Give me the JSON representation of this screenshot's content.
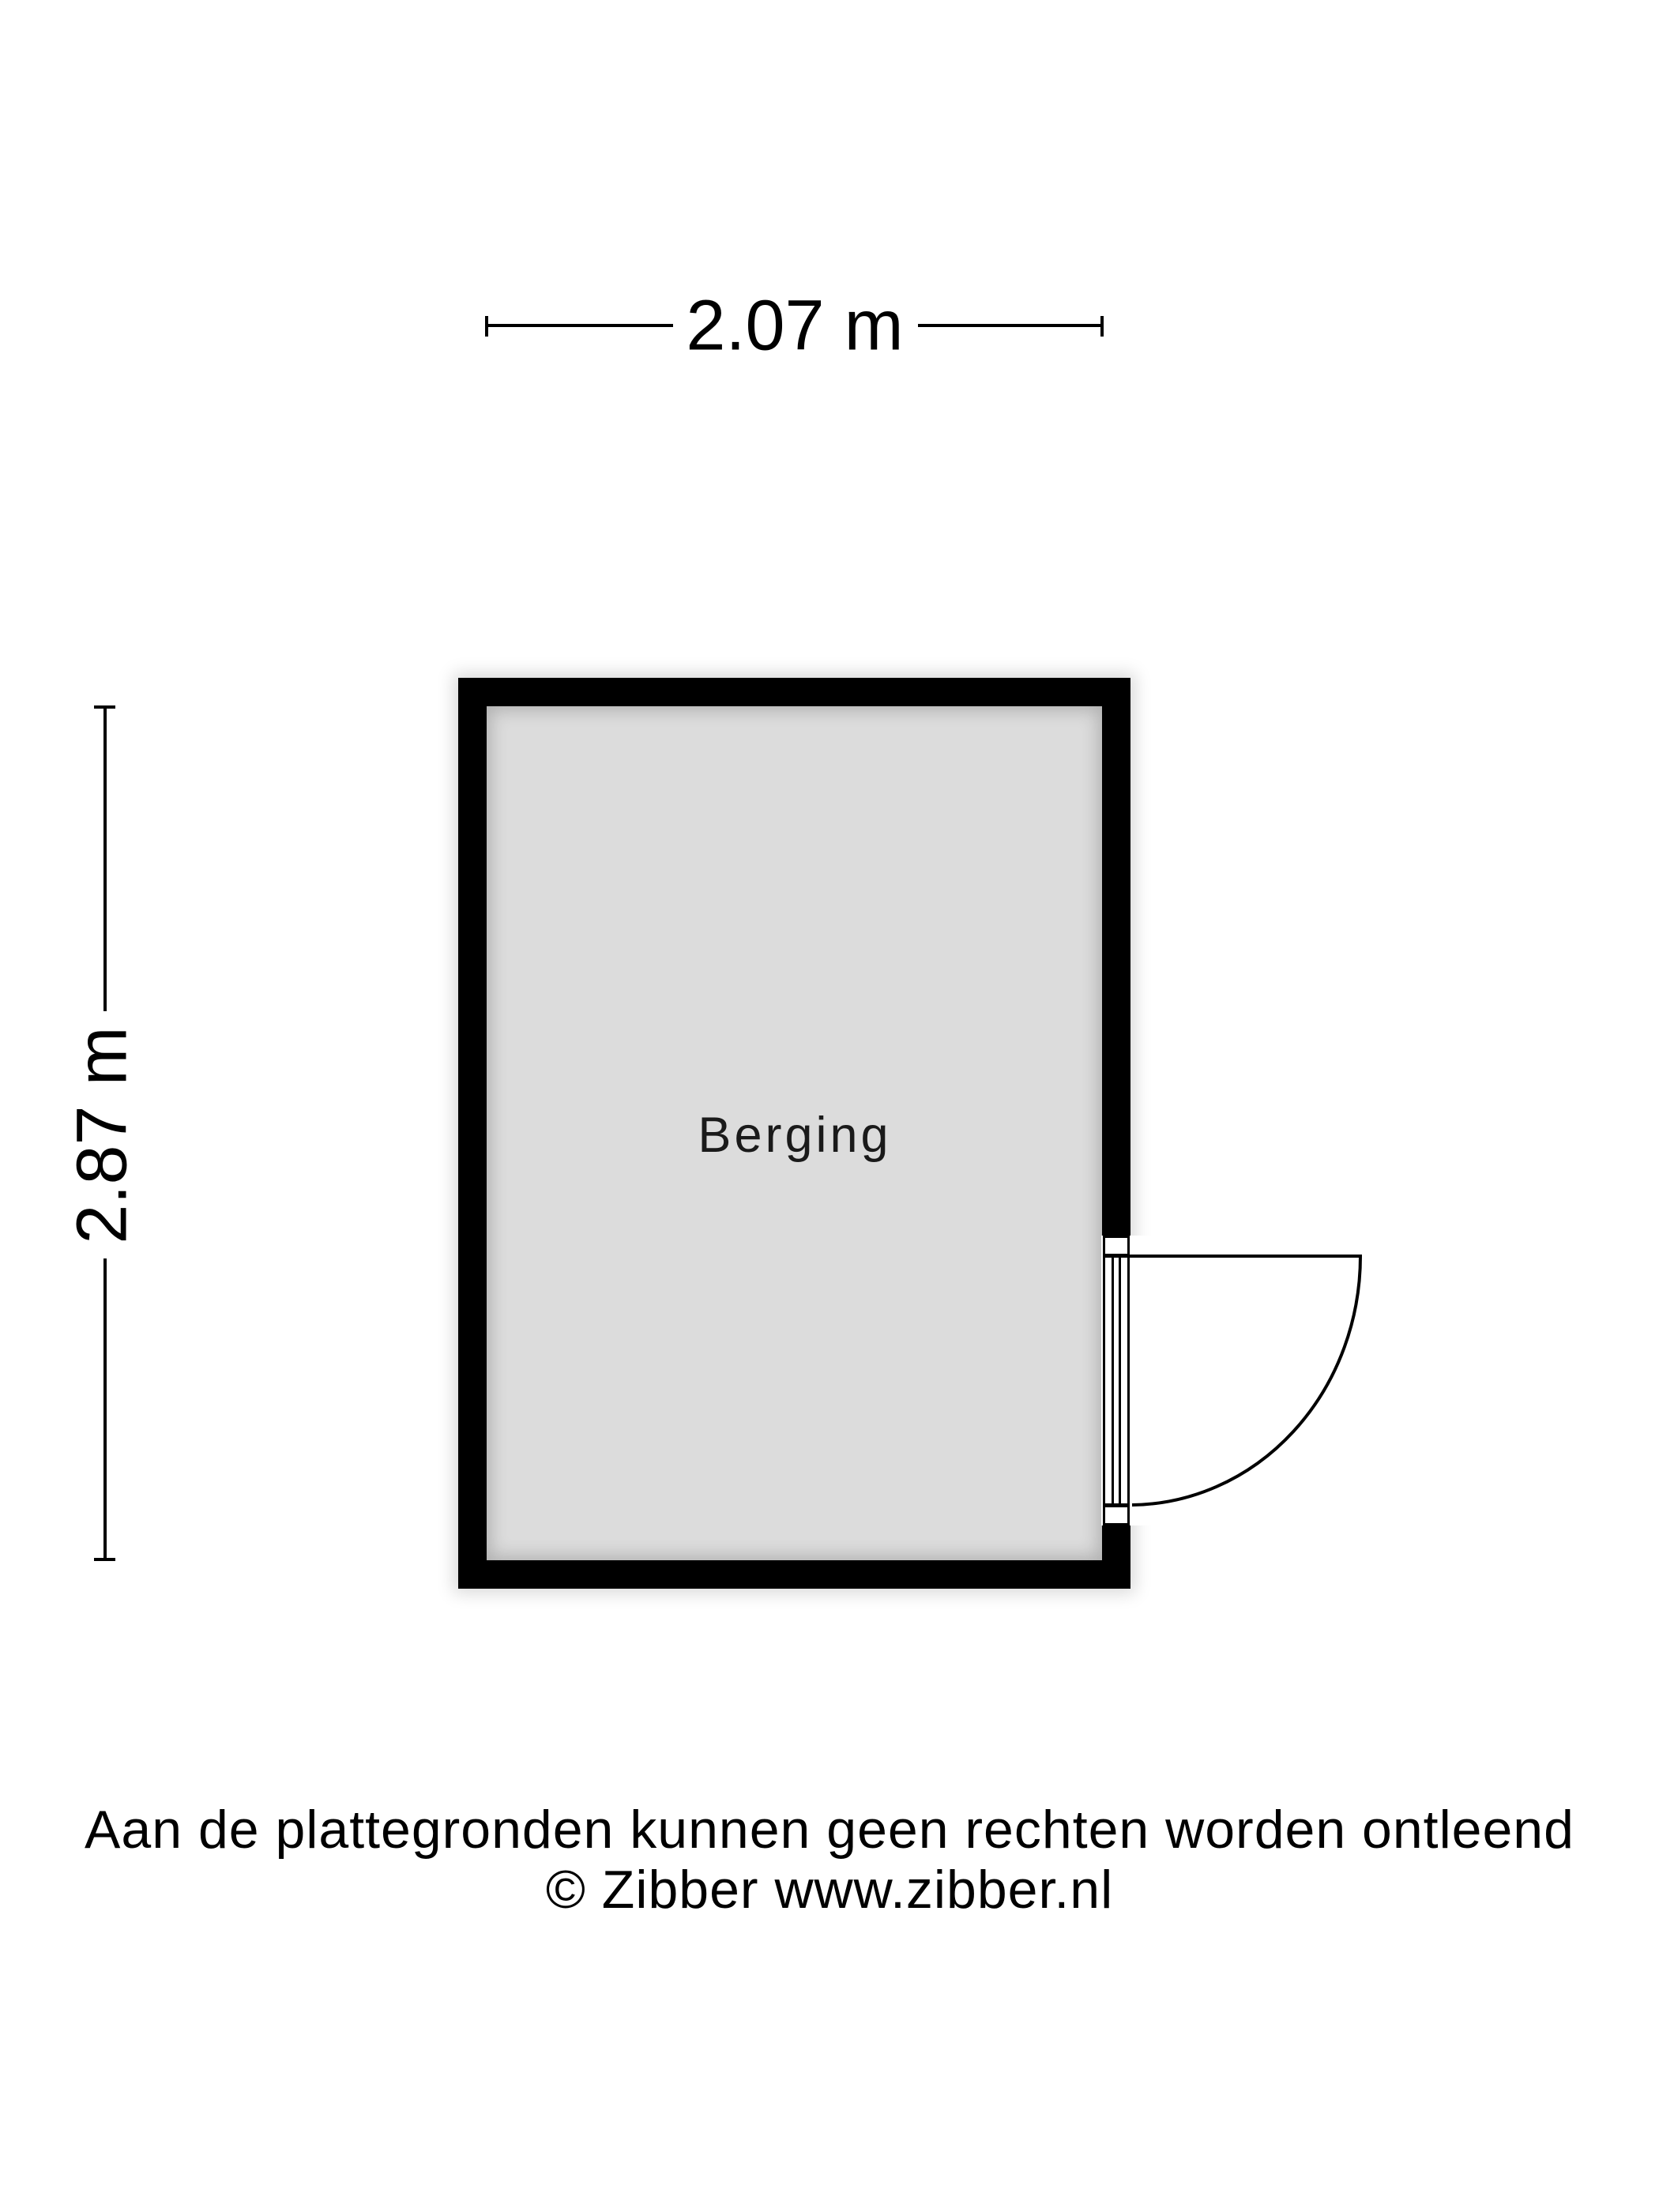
{
  "page": {
    "background": "#ffffff"
  },
  "floorplan": {
    "room": {
      "name": "Berging"
    },
    "dimensions": {
      "width": {
        "label": "2.07 m",
        "meters": 2.07
      },
      "height": {
        "label": "2.87 m",
        "meters": 2.87
      }
    },
    "door": {
      "type": "single-swing",
      "wall": "right",
      "swing": "outward-right"
    },
    "footer": {
      "disclaimer": "Aan de plattegronden kunnen geen rechten worden ontleend",
      "copyright": "© Zibber www.zibber.nl"
    },
    "colors": {
      "wall": "#000000",
      "line": "#000000",
      "room_fill": "#dcdcdc",
      "text": "#1a1a1a"
    }
  }
}
